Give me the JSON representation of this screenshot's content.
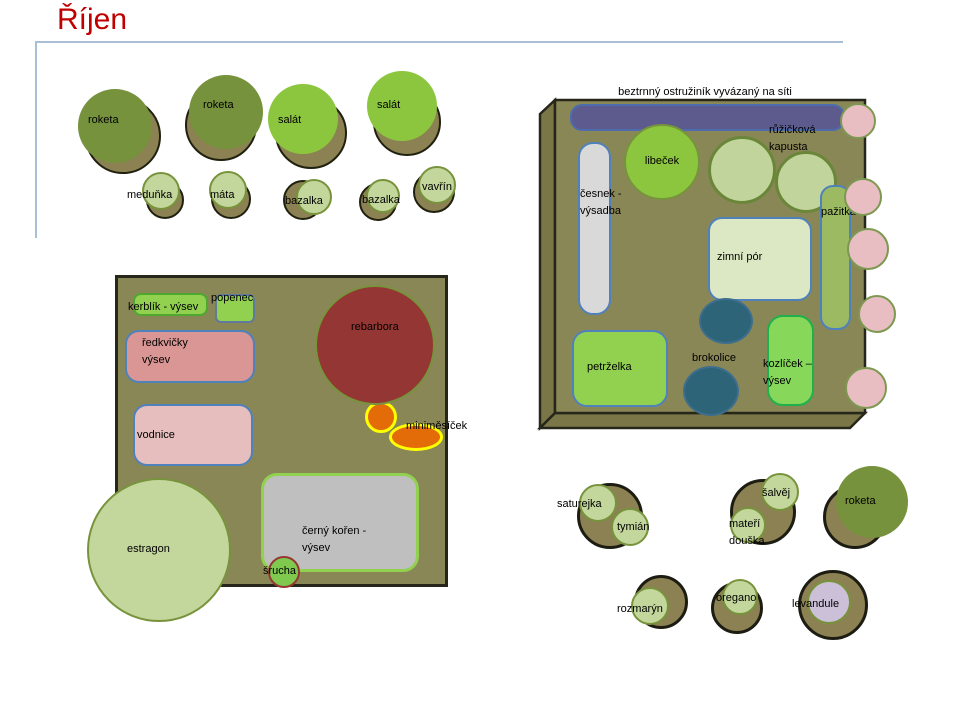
{
  "title": "Říjen",
  "colors": {
    "title_red": "#C00000",
    "guide_line": "#A9BFD6",
    "bed_fill": "#8A8757",
    "bed_side": "#7A7647",
    "bed_border": "#26261A",
    "dark_olive_plant": "#76923C",
    "shadow_olive": "#8B8153",
    "bright_green": "#8CC63F",
    "mid_green": "#92D050",
    "light_sage": "#C3D69B",
    "sage_border": "#77933C",
    "pink_fill": "#E9BEC3",
    "purple_trellis": "#5D5B8D",
    "steel_blue_border": "#4F81BD",
    "gray_fill": "#D9D9D9",
    "pale_green_fill": "#DCE8C4",
    "yellow_green_fill": "#9CBA62",
    "teal_fill": "#2D6478",
    "maroon_fill": "#943634",
    "orange_fill": "#E36C09",
    "yellow_border": "#FFFF00",
    "light_gray_fill": "#BFBFBF",
    "salmon_fill": "#D99694",
    "pale_pink_fill": "#E5BEBD",
    "lavender_fill": "#CCC0D9",
    "kozlicek_border": "#1DB14C"
  },
  "labels": {
    "roketa": "roketa",
    "salat": "salát",
    "medunka": "meduňka",
    "mata": "máta",
    "bazalka": "bazalka",
    "vavrin": "vavřín",
    "bed_note": "beztrnný ostružiník vyvázaný na síti",
    "libecek": "libeček",
    "ruzickova_kapusta": "růžičková\nkapusta",
    "cesnek": "česnek -\nvýsadba",
    "zimni_por": "zimní pór",
    "pazitka": "pažitka",
    "petrzelka": "petrželka",
    "brokolice": "brokolice",
    "kozlicek": "kozlíček –\nvýsev",
    "kerblik": "kerblík - výsev",
    "popenec": "popenec",
    "redkvicky": "ředkvičky\nvýsev",
    "vodnice": "vodnice",
    "rebarbora": "rebarbora",
    "minimesicek": "miniměsíček",
    "estragon": "estragon",
    "cerny_koren": "černý kořen -\nvýsev",
    "srucha": "šrucha",
    "saturejka": "saturejka",
    "tymian": "tymián",
    "salvej": "šalvěj",
    "materi_douska": "mateří\ndouška",
    "rozmaryn": "rozmarýn",
    "oregano": "oregano",
    "levandule": "levandule"
  }
}
